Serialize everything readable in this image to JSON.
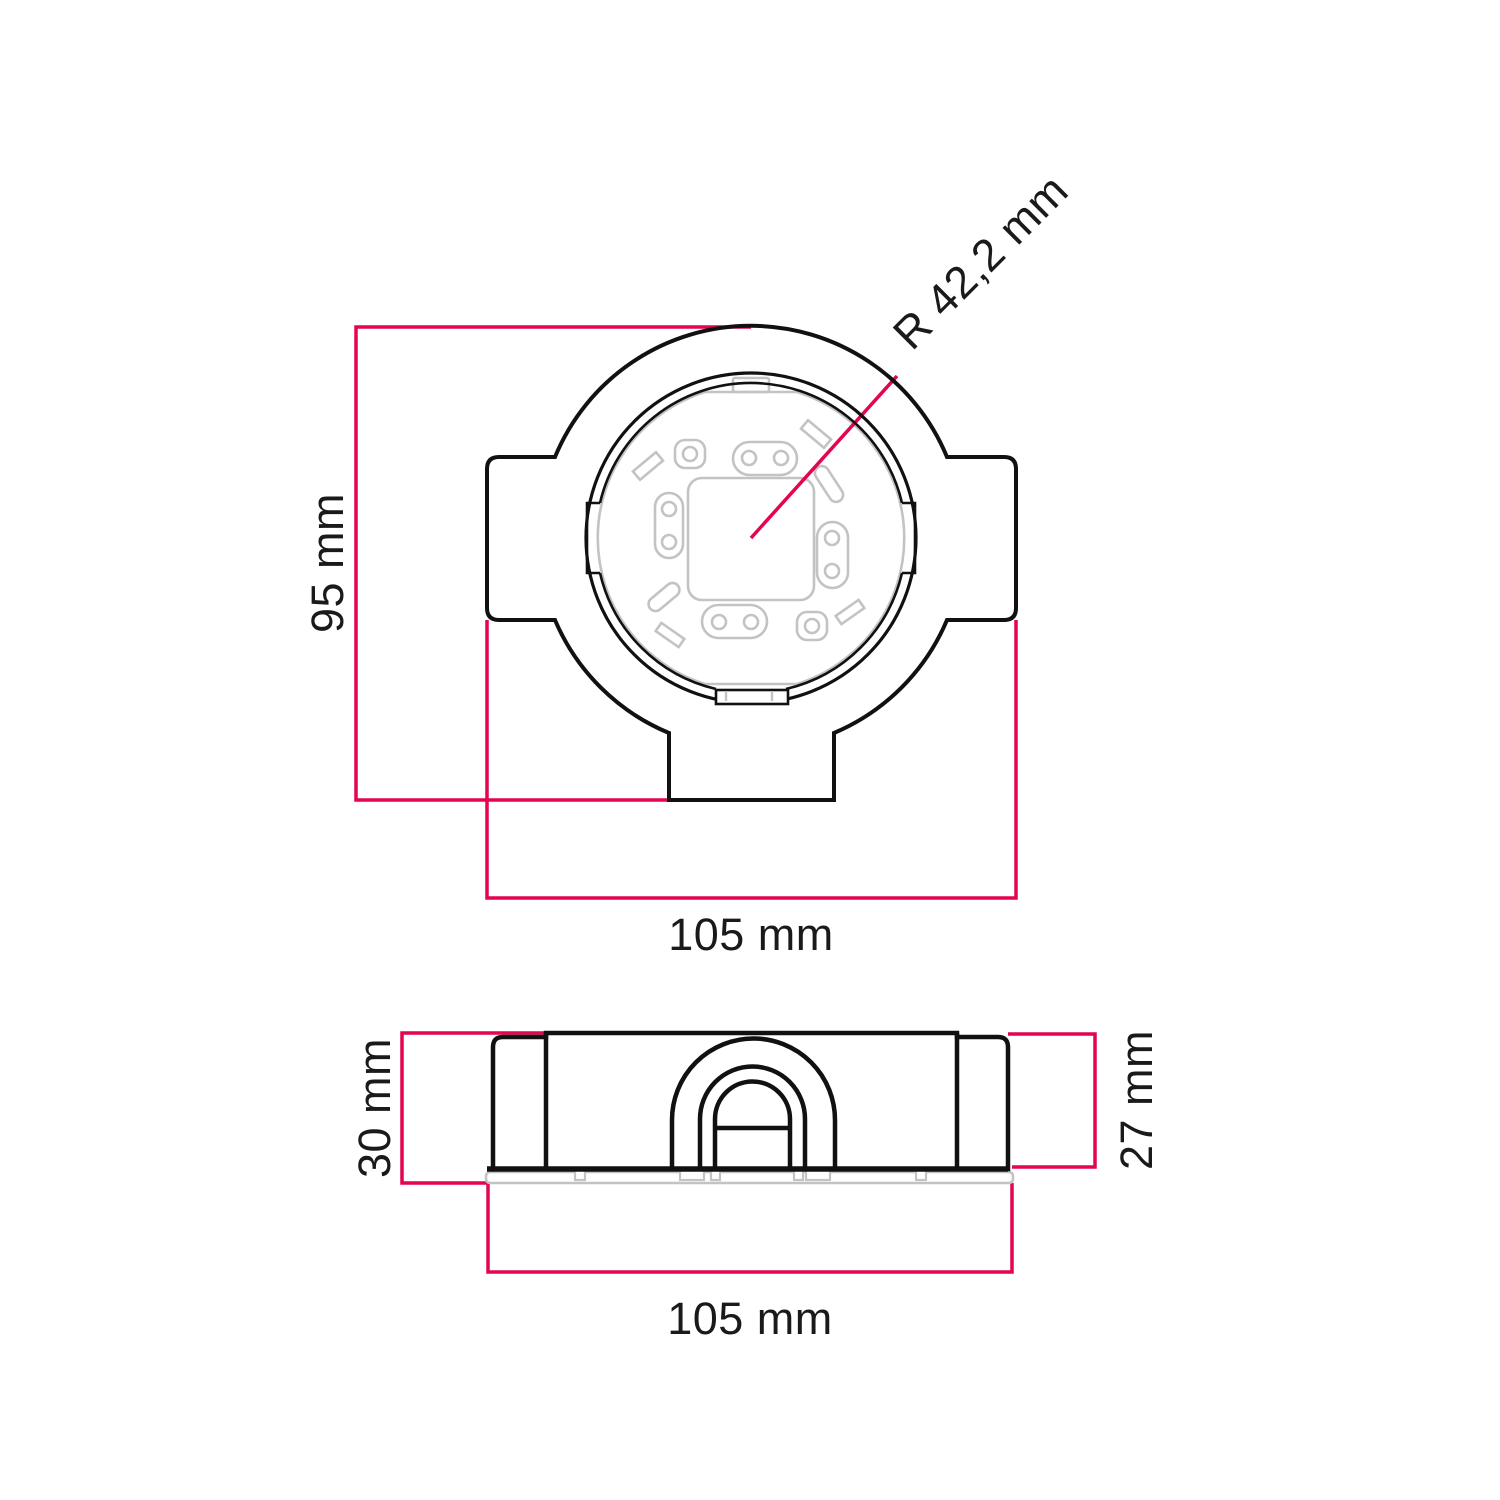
{
  "page": {
    "background": "#ffffff"
  },
  "colors": {
    "outline": "#111111",
    "dimension_pink": "#e30550",
    "detail_gray": "#c3c3c3",
    "label_text": "#1a1a1a"
  },
  "top_view": {
    "height_label": "95 mm",
    "width_label": "105 mm",
    "radius_label": "R 42,2 mm"
  },
  "side_view": {
    "height_overall_label": "30 mm",
    "height_body_label": "27 mm",
    "width_label": "105 mm"
  }
}
